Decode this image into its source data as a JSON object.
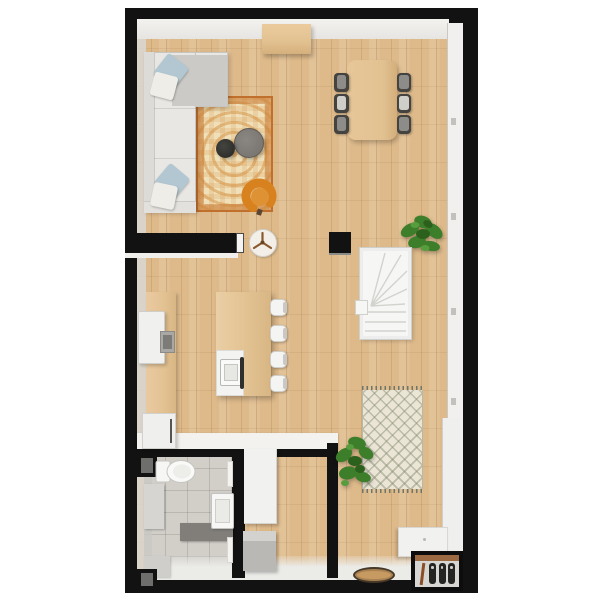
{
  "scene": {
    "kind": "3d-floor-plan-top-view",
    "background": "#ffffff",
    "palette": {
      "outer_wall": "#121212",
      "wall_face_light": "#e6e5e2",
      "wall_face_side": "#d8d7d3",
      "window_frame": "#f1f0ee",
      "wood_floor": "#deba8b",
      "tile_floor": "#d2cfc9",
      "south_face": "#ebebe8",
      "sofa_light": "#e8e7e3",
      "sofa_dark": "#cbcac6",
      "pillow_blue": "#b2c7d1",
      "pillow_white": "#efede7",
      "rug_border": "#c06f2c",
      "rug_field": "#efe0ba",
      "rug_motif": "#d6964a",
      "coffee_table_gray": "#7b7773",
      "coffee_table_black": "#2e2e2c",
      "armchair_orange": "#d8821f",
      "wood_furniture": "#e3c292",
      "chair_frame": "#44433f",
      "chair_seat_gray": "#8e8c88",
      "chair_seat_light": "#cfcec9",
      "white_furniture": "#f3f3f1",
      "appliance_gray": "#a9a8a4",
      "stair_white": "#f6f6f4",
      "plant_green": "#3d7e2a",
      "plant_green_dark": "#2c611d",
      "plant_green_light": "#579c3d",
      "moroccan_field": "#eae5d4",
      "doormat_tan": "#c79a61",
      "doormat_edge": "#473828",
      "shoe_dark": "#242422",
      "shoe_brown": "#8a4f28",
      "bath_gray": "#817e7a",
      "cabinet_gray": "#d6d5d1"
    },
    "rooms": [
      {
        "name": "living-room",
        "furniture": [
          "corner-sofa",
          "throw-pillows",
          "ornate-area-rug",
          "coffee-table-large",
          "coffee-table-small",
          "orange-armchair",
          "sideboard"
        ]
      },
      {
        "name": "dining-area",
        "furniture": [
          "dining-table",
          "dining-chairs",
          "potted-plant"
        ]
      },
      {
        "name": "kitchen",
        "furniture": [
          "wall-counter",
          "fridge",
          "cooktop",
          "base-cabinet",
          "kitchen-island",
          "island-sink",
          "bar-stools",
          "round-side-table"
        ]
      },
      {
        "name": "hallway-entry",
        "furniture": [
          "staircase",
          "moroccan-rug",
          "potted-plant",
          "window-bench",
          "entry-bench",
          "shoe-rack",
          "doormat"
        ]
      },
      {
        "name": "bathroom",
        "furniture": [
          "toilet",
          "washbasin",
          "vanity-counter",
          "side-cabinet",
          "bench",
          "duct-shaft-top",
          "duct-shaft-bottom"
        ]
      },
      {
        "name": "storage-room",
        "furniture": [
          "wardrobe-cabinet",
          "storage-box"
        ]
      }
    ],
    "counts": {
      "dining_chairs": 6,
      "bar_stools": 4,
      "sofa_pillows": 4,
      "stair_straight_treads": 3,
      "stair_winder_treads": 5,
      "shoe_pairs": 3,
      "window_handles": 4,
      "plants": 2
    },
    "dining_chair_seat_colors": [
      "#8e8c88",
      "#cfcec9",
      "#8e8c88"
    ]
  }
}
